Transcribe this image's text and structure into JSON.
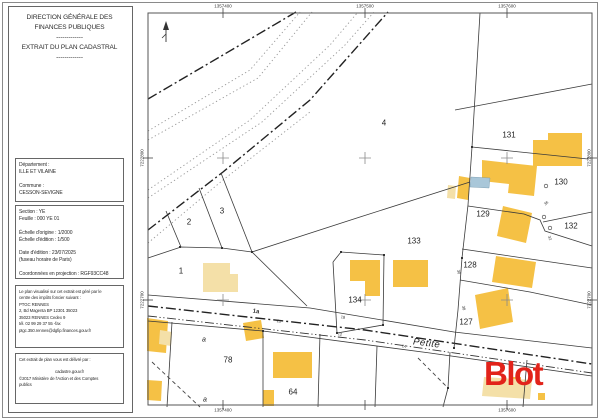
{
  "title_block": {
    "lines": [
      "DIRECTION GÉNÉRALE DES",
      "FINANCES PUBLIQUES",
      "-------------",
      "EXTRAIT DU PLAN CADASTRAL",
      "-------------"
    ]
  },
  "department_block": {
    "lines": [
      "Département :",
      "ILLE ET VILAINE",
      "",
      "Commune :",
      "CESSON-SEVIGNE"
    ]
  },
  "section_block": {
    "lines": [
      "Section : YE",
      "Feuille : 000 YE 01",
      "",
      "Échelle d'origine : 1/2000",
      "Échelle d'édition : 1/500",
      "",
      "Date d'édition : 23/07/2025",
      "(fuseau horaire de Paris)",
      "",
      "Coordonnées en projection : RGF93CC48"
    ]
  },
  "office_block": {
    "lines": [
      "Le plan visualisé sur cet extrait est géré par le",
      "centre des impôts foncier suivant :",
      "PTGC RENNES",
      "2, Bd Magenta BP 12301 35023",
      "35023 RENNES Cedex 9",
      "tél. 02 99 29 37 55 -fax",
      "ptgc.350.rennes@dgfip.finances.gouv.fr"
    ]
  },
  "issuer_block": {
    "lines": [
      "Cet extrait de plan vous est délivré par :",
      "",
      "cadastre.gouv.fr",
      "©2017 Ministère de l'Action et des Comptes",
      "publics"
    ]
  },
  "map": {
    "road_label": "Petite",
    "watermark": "Blot",
    "colors": {
      "building_dark": "#F5C145",
      "building_light": "#F4E0A8",
      "pool": "#A9C7D9",
      "logo_red": "#E2231A",
      "boundary": "#3a3a3a",
      "grid_cross": "#8a8a8a"
    },
    "grid_labels": {
      "top": [
        {
          "t": "1357400",
          "x": 223
        },
        {
          "t": "1357500",
          "x": 365
        },
        {
          "t": "1357600",
          "x": 507
        }
      ],
      "bottom": [
        {
          "t": "1357400",
          "x": 223
        },
        {
          "t": "1357600",
          "x": 507
        }
      ],
      "left": [
        {
          "t": "7222800",
          "y": 158
        },
        {
          "t": "7222700",
          "y": 300
        }
      ],
      "right": [
        {
          "t": "7222800",
          "y": 158
        },
        {
          "t": "7222700",
          "y": 300
        }
      ]
    },
    "ticks": {
      "top_x": [
        223,
        365,
        507
      ],
      "bottom_x": [
        223,
        365,
        507
      ],
      "left_y": [
        158,
        300
      ],
      "right_y": [
        158,
        300
      ]
    },
    "crosses": [
      [
        223,
        158
      ],
      [
        365,
        158
      ],
      [
        507,
        158
      ],
      [
        223,
        300
      ],
      [
        365,
        300
      ],
      [
        507,
        300
      ]
    ],
    "parcel_labels": [
      {
        "t": "1",
        "x": 181,
        "y": 271
      },
      {
        "t": "2",
        "x": 189,
        "y": 222
      },
      {
        "t": "3",
        "x": 222,
        "y": 211
      },
      {
        "t": "4",
        "x": 384,
        "y": 123
      },
      {
        "t": "78",
        "x": 228,
        "y": 360
      },
      {
        "t": "64",
        "x": 293,
        "y": 392
      },
      {
        "t": "133",
        "x": 414,
        "y": 241
      },
      {
        "t": "134",
        "x": 355,
        "y": 300
      },
      {
        "t": "131",
        "x": 509,
        "y": 135
      },
      {
        "t": "130",
        "x": 561,
        "y": 182
      },
      {
        "t": "129",
        "x": 483,
        "y": 214
      },
      {
        "t": "132",
        "x": 571,
        "y": 226
      },
      {
        "t": "128",
        "x": 470,
        "y": 265
      },
      {
        "t": "127",
        "x": 466,
        "y": 322
      }
    ],
    "sub_labels": [
      {
        "t": "a",
        "x": 204,
        "y": 340
      },
      {
        "t": "a",
        "x": 205,
        "y": 400
      }
    ],
    "dim_labels": [
      {
        "t": "1a",
        "x": 256,
        "y": 312,
        "r": 8,
        "s": 6,
        "b": 1
      },
      {
        "t": "21",
        "x": 279,
        "y": 321,
        "r": 8,
        "s": 4
      },
      {
        "t": "18",
        "x": 343,
        "y": 317,
        "r": 8,
        "s": 4
      },
      {
        "t": "12",
        "x": 340,
        "y": 334,
        "r": 8,
        "s": 4
      },
      {
        "t": "14",
        "x": 404,
        "y": 346,
        "r": 9,
        "s": 4
      },
      {
        "t": "30",
        "x": 459,
        "y": 272,
        "r": 78,
        "s": 4
      },
      {
        "t": "38",
        "x": 464,
        "y": 308,
        "r": 78,
        "s": 4
      },
      {
        "t": "36",
        "x": 546,
        "y": 203,
        "r": -40,
        "s": 4
      },
      {
        "t": "32",
        "x": 550,
        "y": 238,
        "r": 70,
        "s": 4
      }
    ],
    "geometry": {
      "frame": {
        "x": 148,
        "y": 13,
        "w": 444,
        "h": 392
      },
      "buildings_dark": [
        "548,133 582,133 582,166 533,166 533,140 548,140",
        "482,160 537,166 534,196 508,193 509,184 482,181",
        "503,206 532,213 526,243 497,236",
        "496,256 536,262 532,288 492,282",
        "475,295 508,288 513,322 480,329",
        "350,260 380,260 380,296 365,296 365,281 350,281",
        "393,260 428,260 428,287 393,287",
        "459,176 470,178 468,200 457,198",
        "147,318 168,321 166,353 147,351",
        "243,323 261,320 264,338 246,341",
        "273,352 312,352 312,378 273,378",
        "263,390 274,390 274,406 263,406",
        "147,380 162,381 161,401 147,400",
        "512,377 521,377 521,386 512,386",
        "538,393 545,393 545,400 538,400"
      ],
      "buildings_light": [
        "203,263 230,263 230,274 238,274 238,292 203,292",
        "448,185 456,186 455,199 447,198",
        "160,330 172,332 171,346 159,344",
        "484,377 532,380 530,399 482,396"
      ],
      "pool": "471,177 490,178 489,188 470,187",
      "lines": [
        {
          "c": "bold",
          "p": "148,99 240,45 296,12"
        },
        {
          "c": "bold",
          "p": "148,230 223,172 310,100 388,12"
        },
        {
          "c": "bold",
          "p": "148,306 365,330 592,364"
        },
        {
          "c": "dot",
          "p": "148,131 250,70 300,12"
        },
        {
          "c": "dot",
          "p": "148,140 258,78 312,12"
        },
        {
          "c": "dot",
          "p": "148,190 250,120 330,45 358,12"
        },
        {
          "c": "dot",
          "p": "148,198 262,122 345,45 374,12"
        },
        {
          "c": "dot",
          "p": "148,243 223,180 310,112"
        },
        {
          "c": "ddd",
          "p": "148,316 365,340 592,373"
        },
        {
          "c": "sol",
          "p": "166,211 181,247"
        },
        {
          "c": "sol",
          "p": "199,188 222,248"
        },
        {
          "c": "sol",
          "p": "221,173 252,252"
        },
        {
          "c": "sol",
          "p": "148,258 181,247 222,248 252,252"
        },
        {
          "c": "sol",
          "p": "252,252 360,217 470,182"
        },
        {
          "c": "sol",
          "p": "252,252 307,306"
        },
        {
          "c": "sol",
          "p": "333,262 341,252 384,255 383,325 337,333 333,262"
        },
        {
          "c": "sol",
          "p": "480,13 472,147 468,205 462,258 458,310 454,348"
        },
        {
          "c": "sol",
          "p": "455,110 592,84"
        },
        {
          "c": "sol",
          "p": "472,147 588,159"
        },
        {
          "c": "sol",
          "p": "468,206 524,214 540,220 545,231 592,246"
        },
        {
          "c": "sol",
          "p": "543,222 592,212"
        },
        {
          "c": "sol",
          "p": "462,249 592,268"
        },
        {
          "c": "sol",
          "p": "460,280 530,292 592,305"
        },
        {
          "c": "sol",
          "p": "148,295 310,308 454,332 592,348"
        },
        {
          "c": "sol",
          "p": "148,321 263,331 430,353 592,376"
        },
        {
          "c": "sol",
          "p": "172,322 167,407"
        },
        {
          "c": "sol",
          "p": "263,331 263,407"
        },
        {
          "c": "sol",
          "p": "320,334 318,407"
        },
        {
          "c": "sol",
          "p": "377,346 375,407"
        },
        {
          "c": "sol",
          "p": "450,352 448,388 443,407"
        },
        {
          "c": "sol",
          "p": "527,360 523,407"
        },
        {
          "c": "dash",
          "p": "152,362 200,407"
        },
        {
          "c": "dash",
          "p": "418,358 448,388"
        }
      ],
      "vertex_dots": [
        [
          180,
          247
        ],
        [
          222,
          248
        ],
        [
          252,
          252
        ],
        [
          341,
          252
        ],
        [
          384,
          255
        ],
        [
          383,
          325
        ],
        [
          337,
          333
        ],
        [
          472,
          147
        ],
        [
          462,
          258
        ],
        [
          454,
          348
        ],
        [
          263,
          331
        ],
        [
          448,
          388
        ]
      ],
      "survey_circles": [
        [
          546,
          186
        ],
        [
          544,
          217
        ],
        [
          550,
          228
        ]
      ]
    }
  }
}
